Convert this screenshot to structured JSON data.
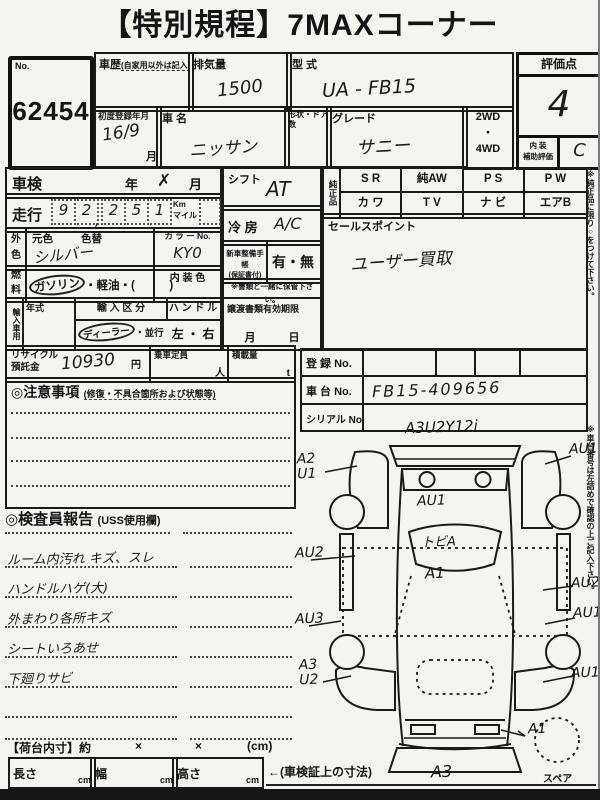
{
  "title": "【特別規程】7MAXコーナー",
  "lot": {
    "label": "No.",
    "value": "62454"
  },
  "header": {
    "history_label": "車歴",
    "history_note": "(自家用以外は記入)",
    "disp_label": "排気量",
    "disp_value": "1500",
    "model_label": "型 式",
    "model_value": "UA - FB15",
    "firstreg_label": "初度登録年月",
    "firstreg_value": "16/9",
    "firstreg_unit": "月",
    "name_label": "車 名",
    "name_value": "ニッサン",
    "shape_label": "形状・ドア数",
    "grade_label": "グレード",
    "grade_value": "サニー",
    "drive_options": "2WD\n・\n4WD"
  },
  "score": {
    "label": "評価点",
    "value": "4",
    "interior_label": "内 装\n補助評価",
    "interior_value": "C"
  },
  "left": {
    "shaken_label": "車検",
    "shaken_year": "年",
    "shaken_mark": "✗",
    "shaken_month": "月",
    "mileage_label": "走行",
    "d0": "9",
    "d1": "2",
    "comma": ",",
    "d2": "2",
    "d3": "5",
    "d4": "1",
    "unit": "Km\nマイル",
    "color_label": "外\n色",
    "base_label": "元色",
    "repaint_label": "色替",
    "color_value": "シルバー",
    "colorno_label": "カ ラ ー No.",
    "colorno_value": "KY0",
    "fuel_label": "燃\n料",
    "fuel_opt1": "ガソリン",
    "fuel_rest": "・軽油・(　　　)",
    "intcolor_label": "内 装 色",
    "import_label": "輸入車用",
    "year_label": "年式",
    "importclass_label": "輸 入 区 分",
    "importclass_opt1": "ディーラー",
    "importclass_rest": "・並行",
    "handle_label": "ハ ン ド ル",
    "handle_options": "左 ・ 右"
  },
  "mid": {
    "shift_label": "シフト",
    "shift_value": "AT",
    "ac_label": "冷 房",
    "ac_value": "A/C",
    "book_label": "新車整備手帳",
    "book_note": "(保証書付)",
    "book_options": "有・無",
    "keep_note": "※書類と一緒に保管下さい。",
    "transfer_label": "譲渡書類有効期限",
    "transfer_fields": "月　　　日"
  },
  "oem": {
    "label": "純正品",
    "r1c1": "S R",
    "r1c2": "純AW",
    "r1c3": "P S",
    "r1c4": "P W",
    "r2c1": "カ ワ",
    "r2c2": "T V",
    "r2c3": "ナ ビ",
    "r2c4": "エアB",
    "sales_label": "セールスポイント",
    "sales_value": "ユーザー買取"
  },
  "sidenotes": {
    "n1": "※純正品に限り○をつけて下さい。",
    "n2": "※車台番号は左詰めで確認の上ご記入下さい。"
  },
  "recycle": {
    "label": "リサイクル\n預託金",
    "value": "10930",
    "unit": "円",
    "cap_label": "乗車定員",
    "cap_unit": "人",
    "load_label": "積載量",
    "load_unit": "t"
  },
  "reg": {
    "reg_label": "登 録 No.",
    "chassis_label": "車 台 No.",
    "chassis_value": "FB15-409656",
    "serial_label": "シリアル No."
  },
  "caution": {
    "title": "◎注意事項",
    "subtitle": "(修復・不具合箇所および状態等)"
  },
  "inspector": {
    "title": "◎検査員報告",
    "subtitle": "(USS使用欄)",
    "l1": "ルーム内汚れ キズ、スレ",
    "l2": "ハンドルハゲ(大)",
    "l3": "外まわり各所キズ",
    "l4": "シートいろあせ",
    "l5": "下廻りサビ"
  },
  "cargo": {
    "label": "【荷台内寸】約",
    "x1": "×",
    "x2": "×",
    "unit": "(cm)",
    "len_label": "長さ",
    "wid_label": "幅",
    "hei_label": "高さ",
    "cm": "cm",
    "note": "←(車検証上の寸法)"
  },
  "diagram": {
    "top_note": "A3U2Y12i",
    "lf_fender": "A2\nU1",
    "rf_fender": "AU1",
    "hood": "AU1",
    "windshield": "トビA",
    "roof": "A1",
    "lf_door": "AU2",
    "rf_door": "AU2",
    "lr_door": "AU3",
    "rr_door": "AU1",
    "lr_quarter": "A3\nU2",
    "rr_quarter": "AU1",
    "tail": "A1",
    "rear_bumper": "A3",
    "spare": "スペア"
  }
}
